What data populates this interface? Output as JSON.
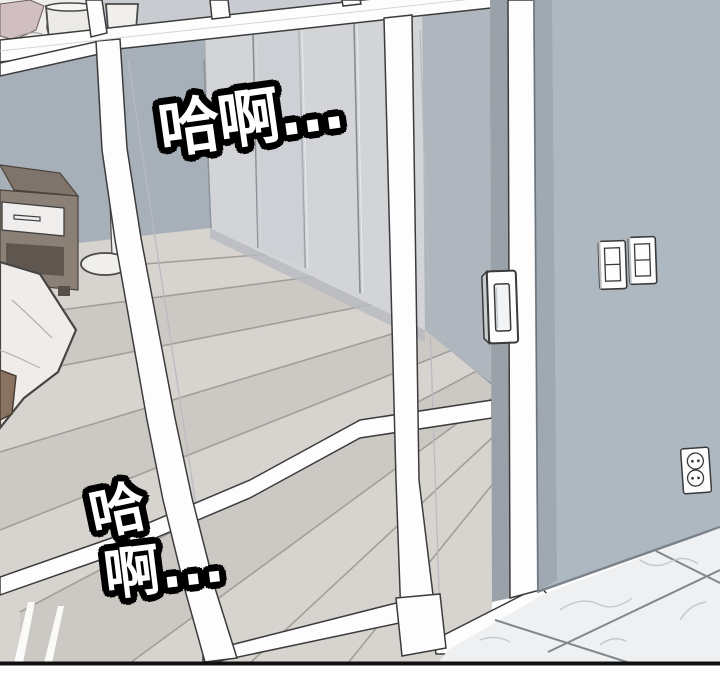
{
  "panel": {
    "type": "webtoon-comic-panel",
    "sfx": {
      "top": "哈啊...",
      "bottom_line1": "哈",
      "bottom_line2": "啊..."
    },
    "scene_objects": [
      "glass-partition-wall",
      "sliding-glass-door",
      "door-recessed-handle",
      "bedroom-closet",
      "bed-with-person",
      "nightstand",
      "floor-lamp",
      "wood-plank-floor",
      "right-wall",
      "light-switch-pair",
      "power-outlet",
      "marble-tile-floor"
    ],
    "colors": {
      "page-bg": "#ffffff",
      "panel-border": "#101010",
      "wall": "#aeb8c1",
      "wall-edge": "#98a2ab",
      "inner-wall": "#a7b0b9",
      "closet": "#d2d4d7",
      "closet-divider": "#878d94",
      "end-wall": "#b0b6bd",
      "door-strip": "#9aa1a8",
      "frame": "#fdfdfd",
      "outline": "#3c3c3c",
      "wood": "#d7d3cf",
      "wood-line": "#a29e99",
      "marble": "#eef0f1",
      "marble-vein": "#c3c9cf",
      "grout": "#82878c",
      "nightstand-top": "#7e746b",
      "nightstand-front": "#8b8076",
      "nightstand-shelf": "#5f574f",
      "drawer": "#f0eeec",
      "bedding": "#efede9",
      "blanket-pink": "#d0bec0",
      "hair": "#e6d7b2",
      "skin": "#f4e6d8",
      "lamp": "#f1efec",
      "sfx-fill": "#ffffff",
      "sfx-stroke": "#000000"
    }
  }
}
